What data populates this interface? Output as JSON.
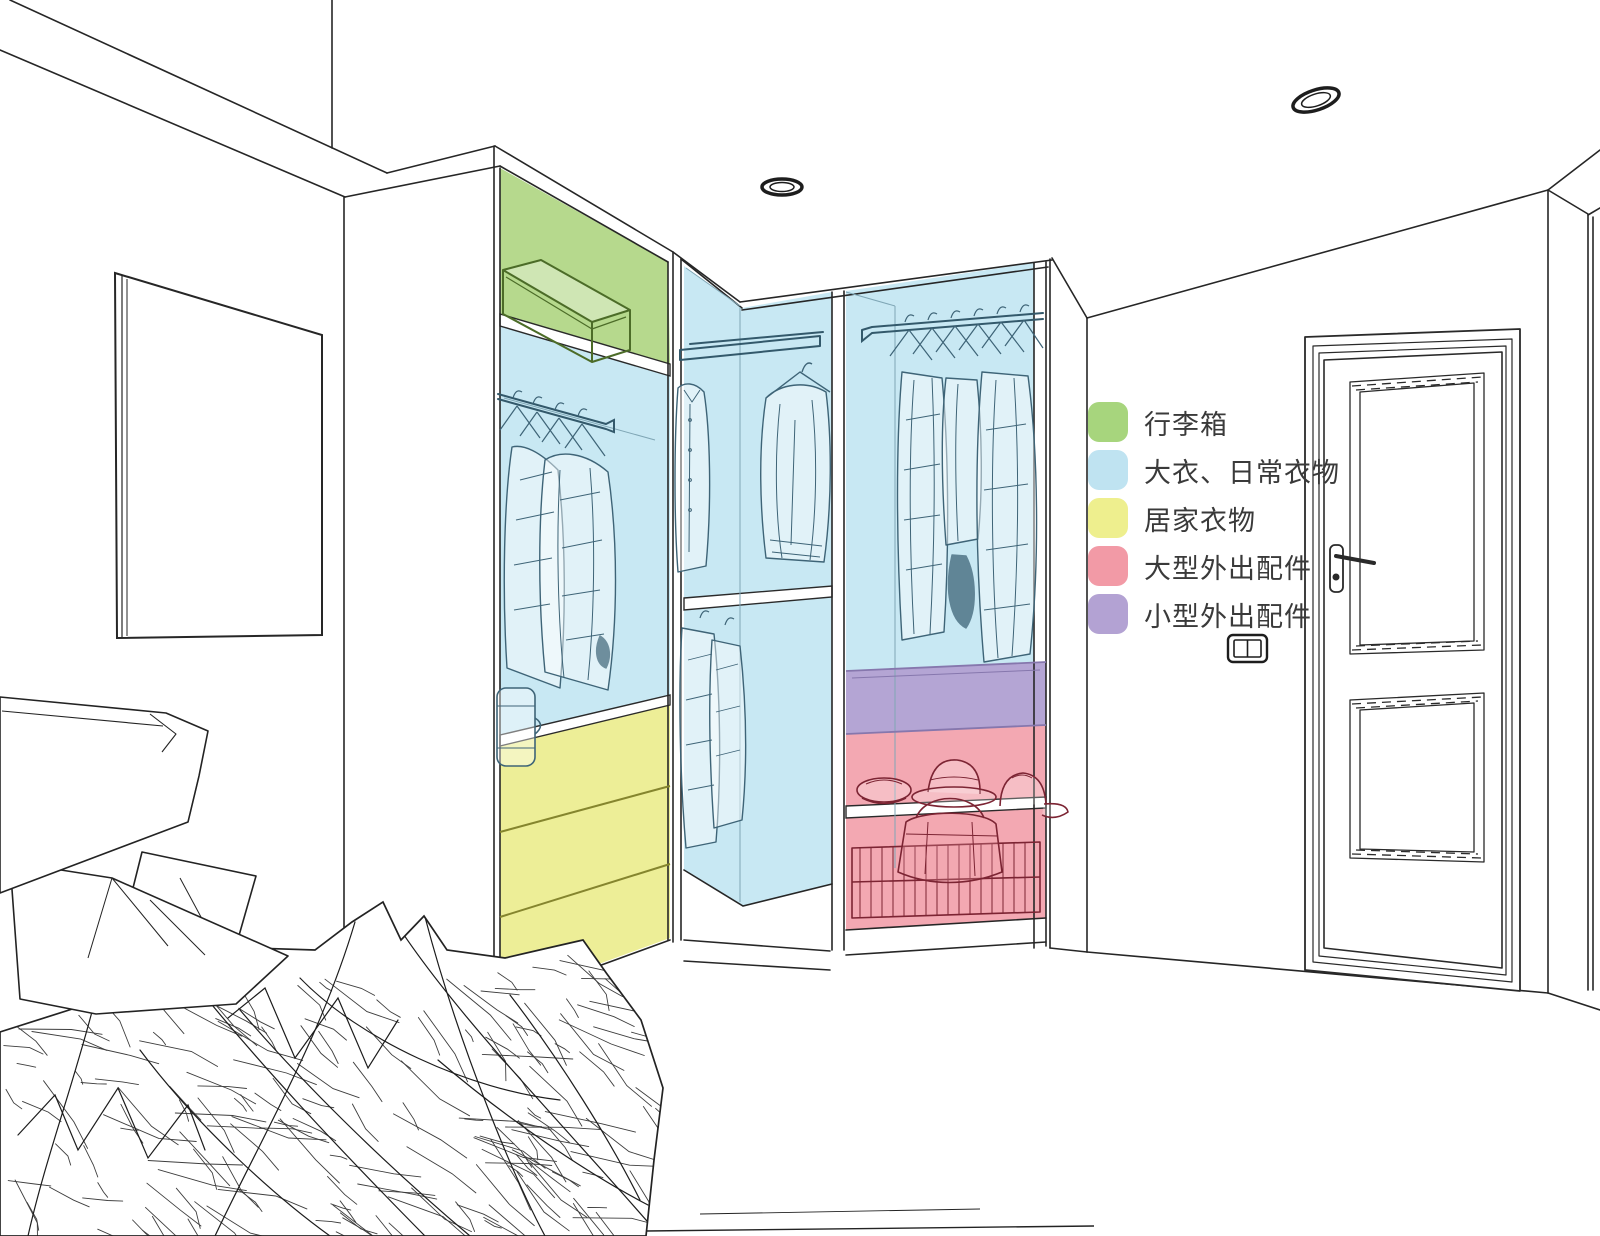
{
  "legend": {
    "items": [
      {
        "id": "luggage",
        "label": "行李箱",
        "color": "#a7d57d"
      },
      {
        "id": "coats-daily",
        "label": "大衣、日常衣物",
        "color": "#bfe3f1"
      },
      {
        "id": "homewear",
        "label": "居家衣物",
        "color": "#eeef8e"
      },
      {
        "id": "large-accessories",
        "label": "大型外出配件",
        "color": "#f29aa6"
      },
      {
        "id": "small-accessories",
        "label": "小型外出配件",
        "color": "#b3a2d3"
      }
    ]
  },
  "zones": {
    "luggage": "#b6d98d",
    "coats_daily": "#c8e8f3",
    "homewear": "#edee97",
    "large_accessories": "#f3a8b2",
    "small_accessories": "#b4a5d4"
  }
}
